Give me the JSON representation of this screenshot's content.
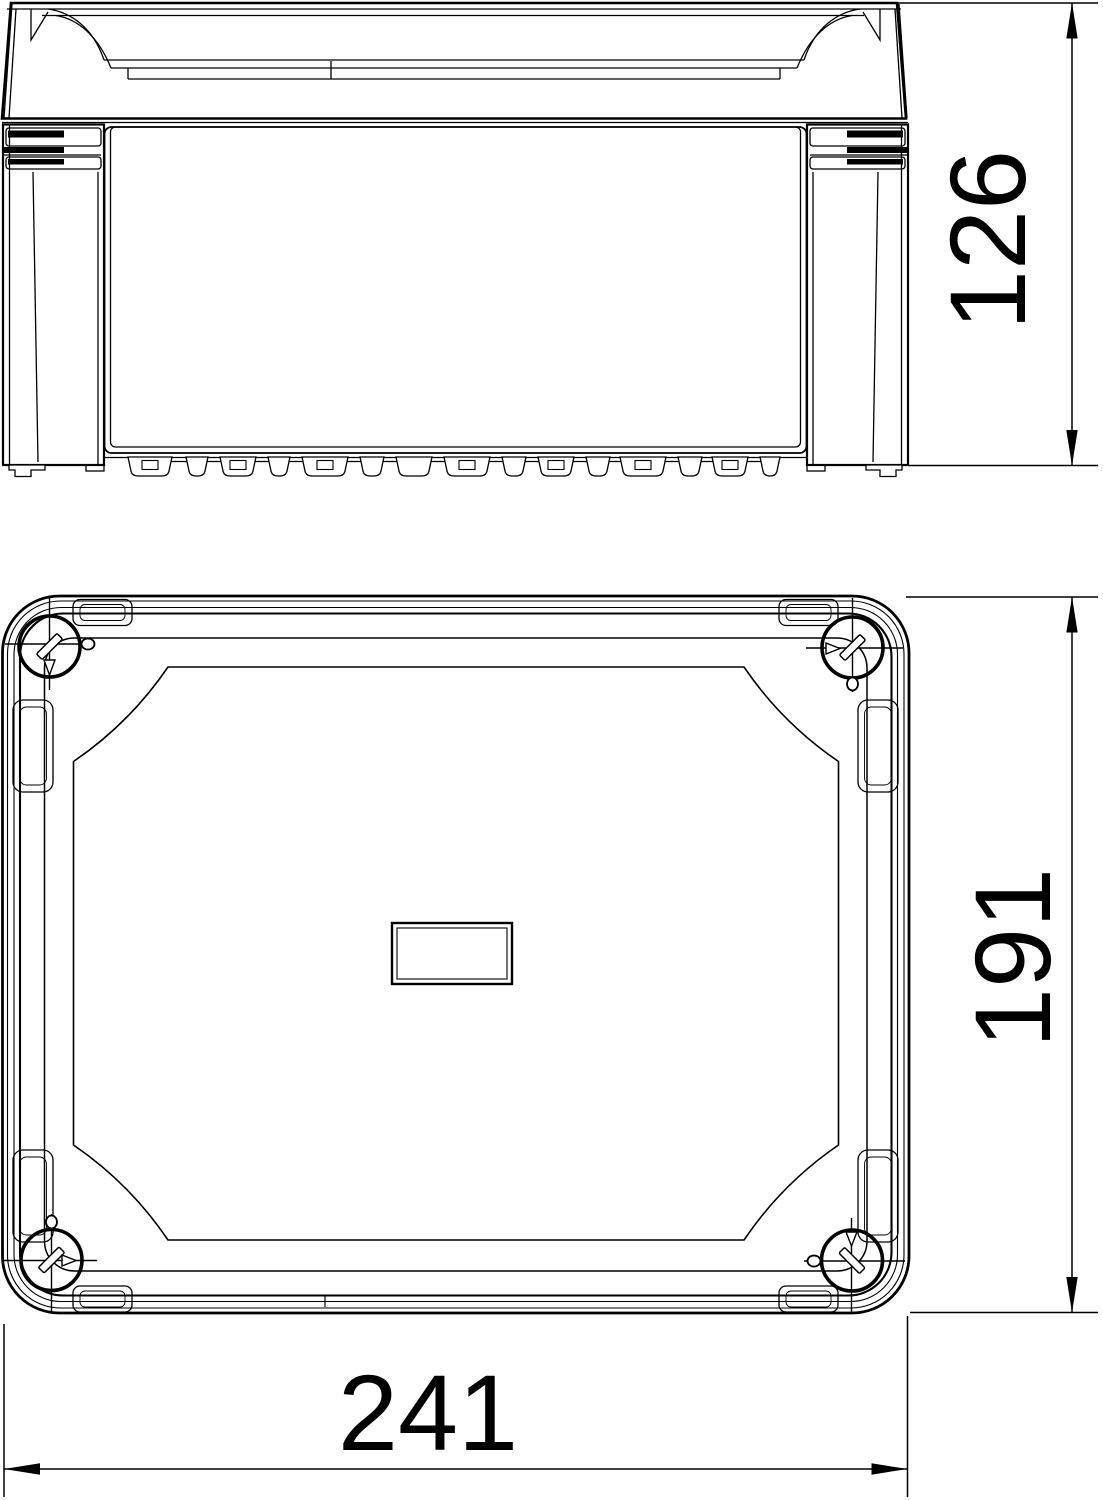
{
  "page": {
    "type": "technical-dimension-drawing",
    "background_color": "#ffffff",
    "line_color": "#000000"
  },
  "views": {
    "side_view": {
      "name": "side-elevation"
    },
    "plan_view": {
      "name": "lid-top-view"
    }
  },
  "dimensions": {
    "height": {
      "value": "126",
      "orientation": "vertical",
      "view": "side_view"
    },
    "depth": {
      "value": "191",
      "orientation": "vertical",
      "view": "plan_view"
    },
    "width": {
      "value": "241",
      "orientation": "horizontal",
      "view": "plan_view"
    }
  }
}
